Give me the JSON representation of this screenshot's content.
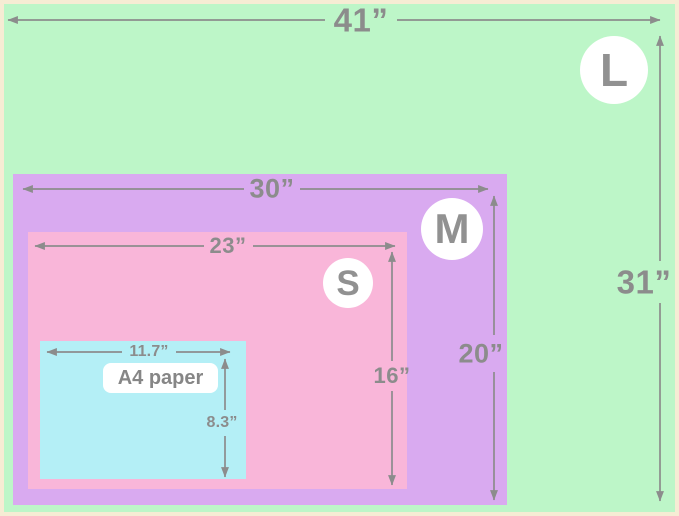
{
  "sizes": {
    "l": {
      "badge": "L",
      "width": "41”",
      "height": "31”",
      "fill": "#bdf6c8"
    },
    "m": {
      "badge": "M",
      "width": "30”",
      "height": "20”",
      "fill": "#d9aaf0"
    },
    "s": {
      "badge": "S",
      "width": "23”",
      "height": "16”",
      "fill": "#f9b6d9"
    },
    "a4": {
      "label": "A4 paper",
      "width": "11.7”",
      "height": "8.3”",
      "fill": "#b4eff6"
    }
  },
  "colors": {
    "page_border": "#f6ecd4",
    "badge_background": "#ffffff",
    "dimension_gray": "#8c8c8c"
  }
}
